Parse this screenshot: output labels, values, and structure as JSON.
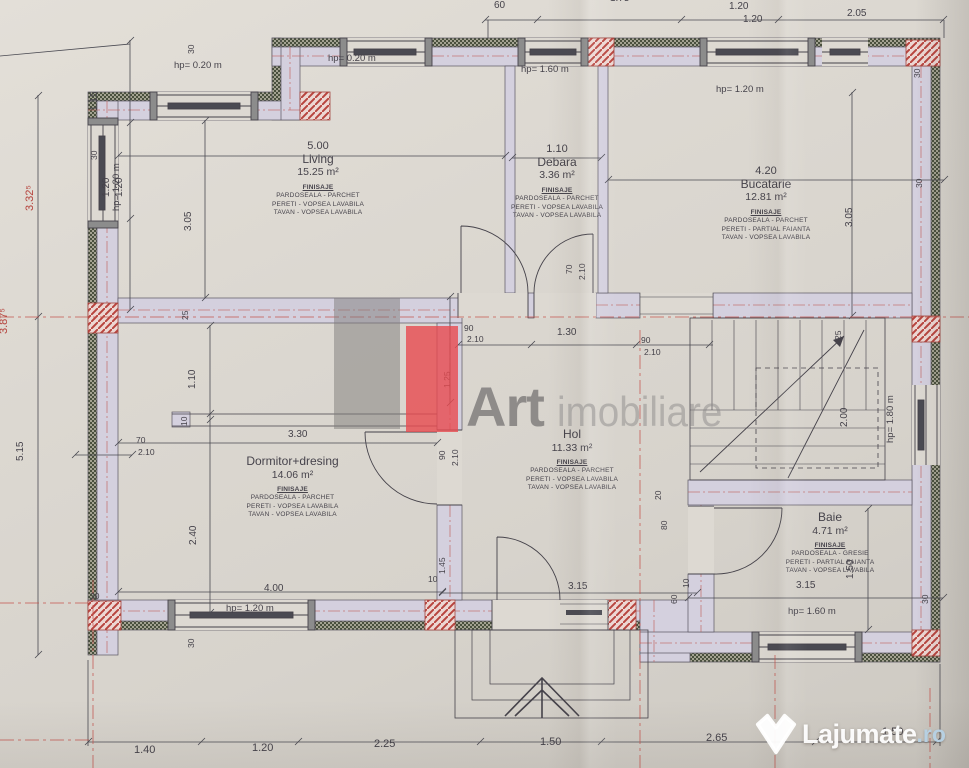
{
  "rooms": {
    "living": {
      "name": "Living",
      "area": "15.25 m²",
      "fin": {
        "title": "FINISAJE",
        "floor": "PARDOSEALA - PARCHET",
        "walls": "PERETI - VOPSEA LAVABILA",
        "ceiling": "TAVAN - VOPSEA LAVABILA"
      }
    },
    "debara": {
      "name": "Debara",
      "area": "3.36 m²",
      "fin": {
        "title": "FINISAJE",
        "floor": "PARDOSEALA - PARCHET",
        "walls": "PERETI - VOPSEA LAVABILA",
        "ceiling": "TAVAN - VOPSEA LAVABILA"
      }
    },
    "bucatarie": {
      "name": "Bucatarie",
      "area": "12.81 m²",
      "fin": {
        "title": "FINISAJE",
        "floor": "PARDOSEALA - PARCHET",
        "walls": "PERETI - PARTIAL FAIANTA",
        "ceiling": "TAVAN - VOPSEA LAVABILA"
      }
    },
    "dormitor": {
      "name": "Dormitor+dresing",
      "area": "14.06 m²",
      "fin": {
        "title": "FINISAJE",
        "floor": "PARDOSEALA - PARCHET",
        "walls": "PERETI - VOPSEA LAVABILA",
        "ceiling": "TAVAN - VOPSEA LAVABILA"
      }
    },
    "hol": {
      "name": "Hol",
      "area": "11.33 m²",
      "fin": {
        "title": "FINISAJE",
        "floor": "PARDOSEALA - PARCHET",
        "walls": "PERETI - VOPSEA LAVABILA",
        "ceiling": "TAVAN - VOPSEA LAVABILA"
      }
    },
    "baie": {
      "name": "Baie",
      "area": "4.71 m²",
      "fin": {
        "title": "FINISAJE",
        "floor": "PARDOSEALA - GRESIE",
        "walls": "PERETI - PARTIAL FAIANTA",
        "ceiling": "TAVAN - VOPSEA LAVABILA"
      }
    }
  },
  "windows": {
    "hp020": "hp= 0.20 m",
    "hp120": "hp= 1.20 m",
    "hp160": "hp= 1.60 m",
    "hp180": "hp= 1.80 m"
  },
  "dims": {
    "d500": "5.00",
    "d110": "1.10",
    "d420": "4.20",
    "d305": "3.05",
    "d115": "1.15",
    "d120": "1.20",
    "d205": "2.05",
    "d175": "1.75",
    "d60": "60",
    "d30": "30",
    "d25": "25",
    "d20": "20",
    "d10": "10",
    "d70": "70",
    "d80": "80",
    "d90": "90",
    "d210": "2.10",
    "d130": "1.30",
    "d125": "1.25",
    "d330": "3.30",
    "d240": "2.40",
    "d400": "4.00",
    "d145": "1.45",
    "d315": "3.15",
    "d150": "1.50",
    "d200": "2.00",
    "d140": "1.40",
    "d225": "2.25",
    "d265": "2.65",
    "d332": "3.32⁵",
    "d387": "3.87⁵",
    "d515": "5.15"
  },
  "watermarks": {
    "agency_word1": "Art",
    "agency_word2": "imobiliare",
    "site_name": "Lajumate",
    "site_tld": ".ro"
  }
}
